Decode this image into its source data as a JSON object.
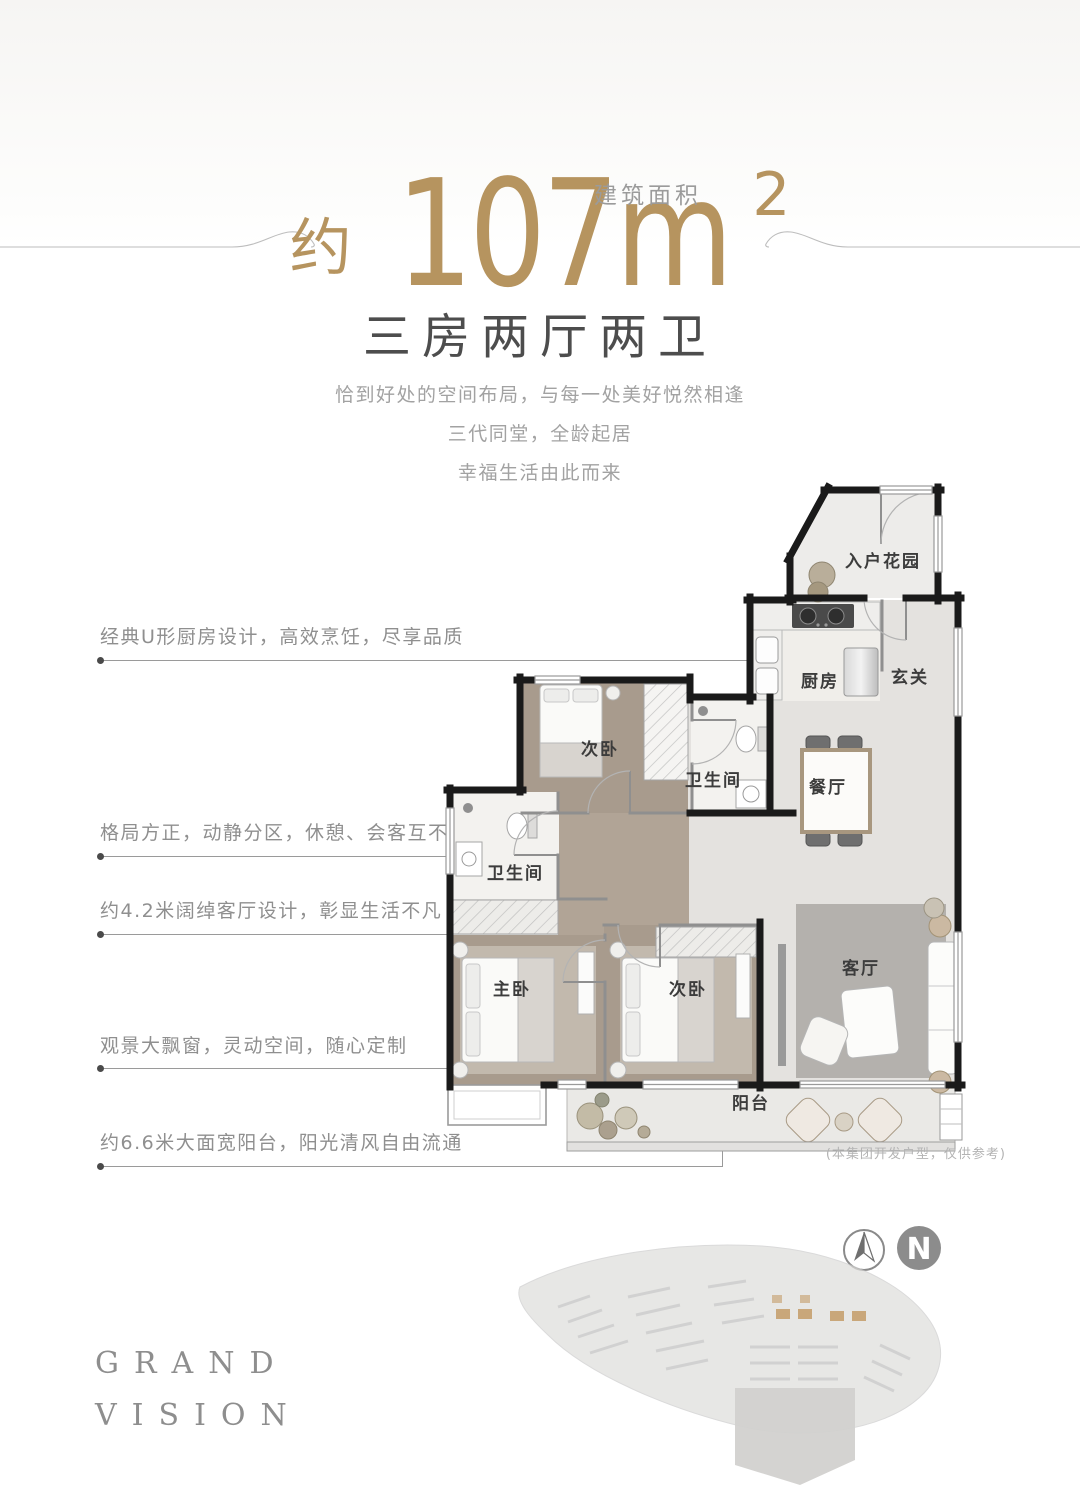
{
  "header": {
    "area_label": "建筑面积",
    "approx": "约",
    "area_number": "107m",
    "area_sup": "2",
    "subtitle": "三房两厅两卫",
    "desc_line1": "恰到好处的空间布局，与每一处美好悦然相逢",
    "desc_line2": "三代同堂，全龄起居",
    "desc_line3": "幸福生活由此而来",
    "accent_color": "#b6945f"
  },
  "callouts": [
    {
      "text": "经典U形厨房设计，高效烹饪，尽享品质"
    },
    {
      "text": "格局方正，动静分区，休憩、会客互不干扰"
    },
    {
      "text": "约4.2米阔绰客厅设计，彰显生活不凡"
    },
    {
      "text": "观景大飘窗，灵动空间，随心定制"
    },
    {
      "text": "约6.6米大面宽阳台，阳光清风自由流通"
    }
  ],
  "floorplan": {
    "rooms": [
      {
        "name": "入户花园"
      },
      {
        "name": "玄关"
      },
      {
        "name": "厨房"
      },
      {
        "name": "餐厅"
      },
      {
        "name": "次卧"
      },
      {
        "name": "卫生间"
      },
      {
        "name": "卫生间"
      },
      {
        "name": "主卧"
      },
      {
        "name": "次卧"
      },
      {
        "name": "客厅"
      },
      {
        "name": "阳台"
      }
    ],
    "disclaimer": "(本集团开发户型，仅供参考)"
  },
  "compass": {
    "label": "N"
  },
  "brand": {
    "line1": "GRAND",
    "line2": "VISION"
  }
}
